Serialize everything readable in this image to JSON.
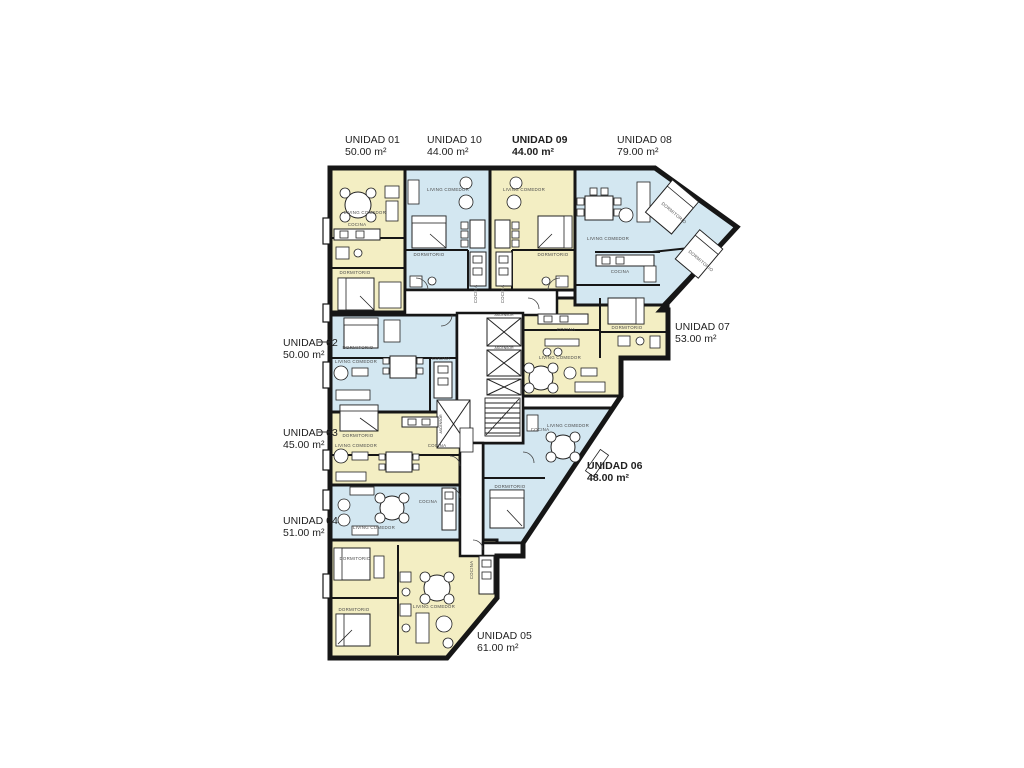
{
  "colors": {
    "unit_yellow": "#f3eec3",
    "unit_blue": "#d3e7f1",
    "wall": "#161616",
    "background": "#ffffff"
  },
  "rooms": {
    "living_comedor": "LIVING COMEDOR",
    "cocina": "COCINA",
    "dormitorio": "DORMITORIO",
    "ascensor": "ASCENSOR"
  },
  "units": [
    {
      "name": "UNIDAD 01",
      "area": "50.00 m²",
      "highlight": false
    },
    {
      "name": "UNIDAD 02",
      "area": "50.00 m²",
      "highlight": false
    },
    {
      "name": "UNIDAD 03",
      "area": "45.00 m²",
      "highlight": false
    },
    {
      "name": "UNIDAD 04",
      "area": "51.00 m²",
      "highlight": false
    },
    {
      "name": "UNIDAD 05",
      "area": "61.00 m²",
      "highlight": false
    },
    {
      "name": "UNIDAD 06",
      "area": "48.00 m²",
      "highlight": true
    },
    {
      "name": "UNIDAD 07",
      "area": "53.00 m²",
      "highlight": false
    },
    {
      "name": "UNIDAD 08",
      "area": "79.00 m²",
      "highlight": false
    },
    {
      "name": "UNIDAD 09",
      "area": "44.00 m²",
      "highlight": true
    },
    {
      "name": "UNIDAD 10",
      "area": "44.00 m²",
      "highlight": false
    }
  ]
}
